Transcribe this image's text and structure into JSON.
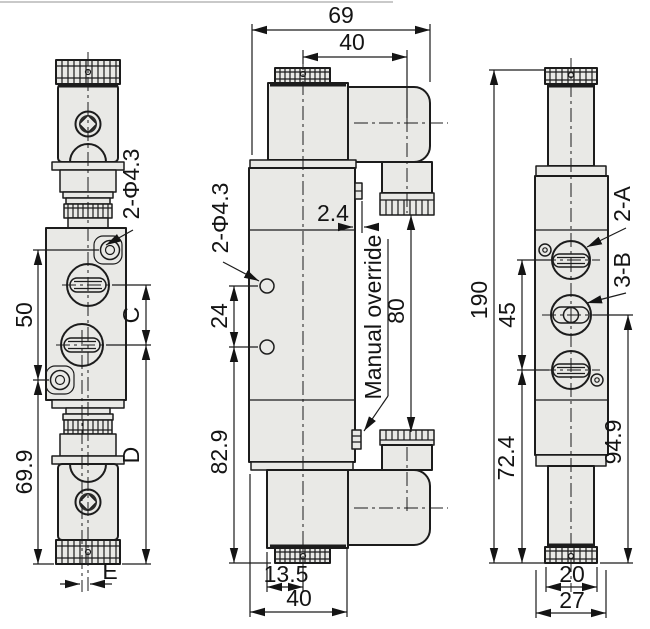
{
  "colors": {
    "background": "#ffffff",
    "part_fill": "#e9e9e6",
    "line": "#1c1c1c"
  },
  "front_view": {
    "dim_50": "50",
    "dim_69_9": "69.9",
    "dim_c": "C",
    "dim_d": "D",
    "dim_e": "E",
    "label_holes": "2-Φ4.3"
  },
  "side_view": {
    "dim_69": "69",
    "dim_40_top": "40",
    "dim_2_4": "2.4",
    "label_holes": "2-Φ4.3",
    "dim_24": "24",
    "dim_82_9": "82.9",
    "dim_80": "80",
    "label_manual_override": "Manual override",
    "dim_13_5": "13.5",
    "dim_40_bottom": "40"
  },
  "end_view": {
    "dim_190": "190",
    "dim_45": "45",
    "dim_72_4": "72.4",
    "dim_94_9": "94.9",
    "dim_20": "20",
    "dim_27": "27",
    "label_port_a": "2-A",
    "label_port_b": "3-B"
  }
}
